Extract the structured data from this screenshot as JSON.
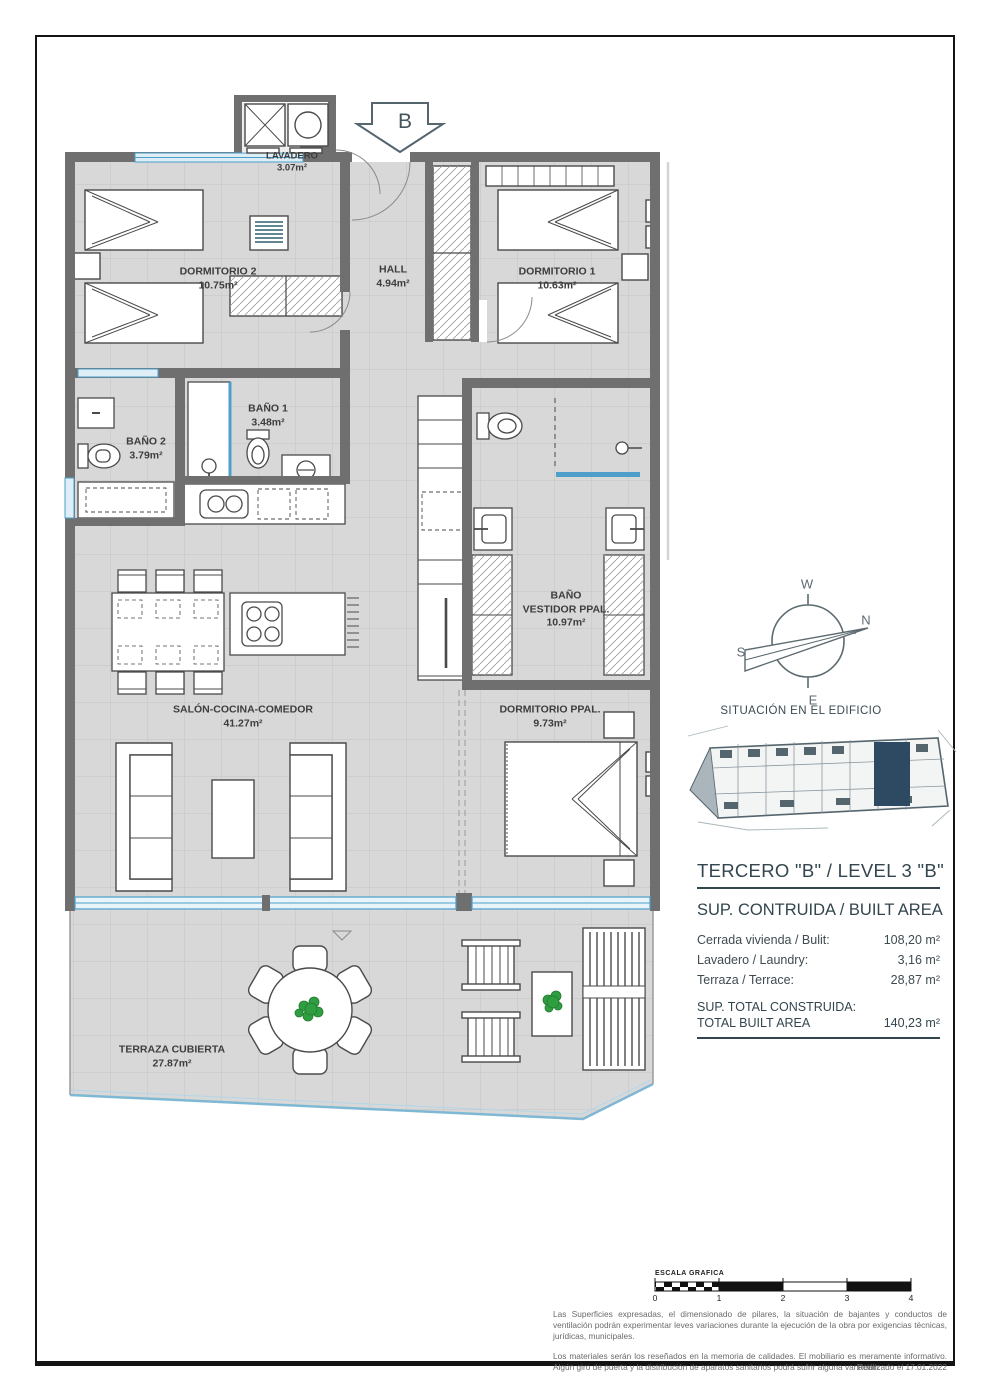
{
  "page": {
    "arrow_label": "B",
    "situacion_label": "SITUACIÓN EN EL EDIFICIO"
  },
  "rooms": {
    "lavadero": {
      "name": "LAVADERO",
      "area": "3.07m²"
    },
    "dormitorio2": {
      "name": "DORMITORIO 2",
      "area": "10.75m²"
    },
    "hall": {
      "name": "HALL",
      "area": "4.94m²"
    },
    "dormitorio1": {
      "name": "DORMITORIO 1",
      "area": "10.63m²"
    },
    "bano1": {
      "name": "BAÑO 1",
      "area": "3.48m²"
    },
    "bano2": {
      "name": "BAÑO 2",
      "area": "3.79m²"
    },
    "bano_vestidor": {
      "name": "BAÑO",
      "name2": "VESTIDOR PPAL.",
      "area": "10.97m²"
    },
    "salon": {
      "name": "SALÓN-COCINA-COMEDOR",
      "area": "41.27m²"
    },
    "dormitorio_ppal": {
      "name": "DORMITORIO PPAL.",
      "area": "9.73m²"
    },
    "terraza": {
      "name": "TERRAZA CUBIERTA",
      "area": "27.87m²"
    }
  },
  "compass": {
    "n": "N",
    "s": "S",
    "e": "E",
    "w": "W"
  },
  "info_panel": {
    "title": "TERCERO \"B\" / LEVEL 3 \"B\"",
    "subtitle": "SUP. CONTRUIDA / BUILT AREA",
    "rows": [
      {
        "label": "Cerrada vivienda / Bulit:",
        "value": "108,20 m²"
      },
      {
        "label": "Lavadero / Laundry:",
        "value": "3,16 m²"
      },
      {
        "label": "Terraza / Terrace:",
        "value": "28,87 m²"
      }
    ],
    "total_label_1": "SUP. TOTAL CONSTRUIDA:",
    "total_label_2": "TOTAL BUILT AREA",
    "total_value": "140,23 m²"
  },
  "scale_bar": {
    "label": "ESCALA GRAFICA",
    "ticks": [
      "0",
      "1",
      "2",
      "3",
      "4"
    ]
  },
  "disclaimer": {
    "para1": "Las Superficies expresadas, el dimensionado de pilares, la situación de bajantes y conductos de ventilación podrán experimentar leves variaciones durante la ejecución de la obra por exigencias técnicas, jurídicas, municipales.",
    "para2": "Los materiales serán los reseñados en la memoria de calidades.  El mobiliario es meramente informativo. Algún giro de puerta y la distribución de aparatos sanitarios podrá sufrir alguna variación.",
    "realizado": "Realizado el 17.01.2022"
  },
  "colors": {
    "wall_gray": "#6f6f6f",
    "floor_gray": "#d8d8d8",
    "glass_blue": "#4d9fca",
    "plant_green": "#2f9e41",
    "heading_teal": "#33454e",
    "highlight_navy": "#2e4a63"
  }
}
